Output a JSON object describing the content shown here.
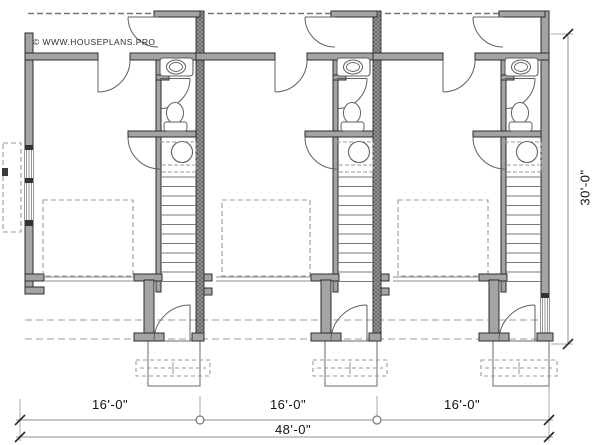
{
  "watermark": {
    "text": "© WWW.HOUSEPLANS.PRO"
  },
  "dimensions": {
    "unit_widths": [
      "16'-0\"",
      "16'-0\"",
      "16'-0\""
    ],
    "total_width": "48'-0\"",
    "total_depth": "30'-0\""
  },
  "plan": {
    "units_count": 3,
    "fixtures_per_unit": [
      "sink",
      "toilet",
      "water-heater",
      "stairs",
      "entry-door",
      "garage-door"
    ]
  },
  "colors": {
    "bg": "#ffffff",
    "wall_fill": "#a4a4a4",
    "wall_edge": "#2d2d2d",
    "hatch_fill": "#9b9b9b",
    "hatch_line": "#5a5a5a",
    "fixture_line": "#5f5f5f",
    "light_line": "#8c8c8c",
    "dashed_line": "#b0b0b0",
    "dash_mid": "#999999",
    "dim_line": "#8f8f8f",
    "tick": "#2a2a2a",
    "text": "#141414"
  }
}
